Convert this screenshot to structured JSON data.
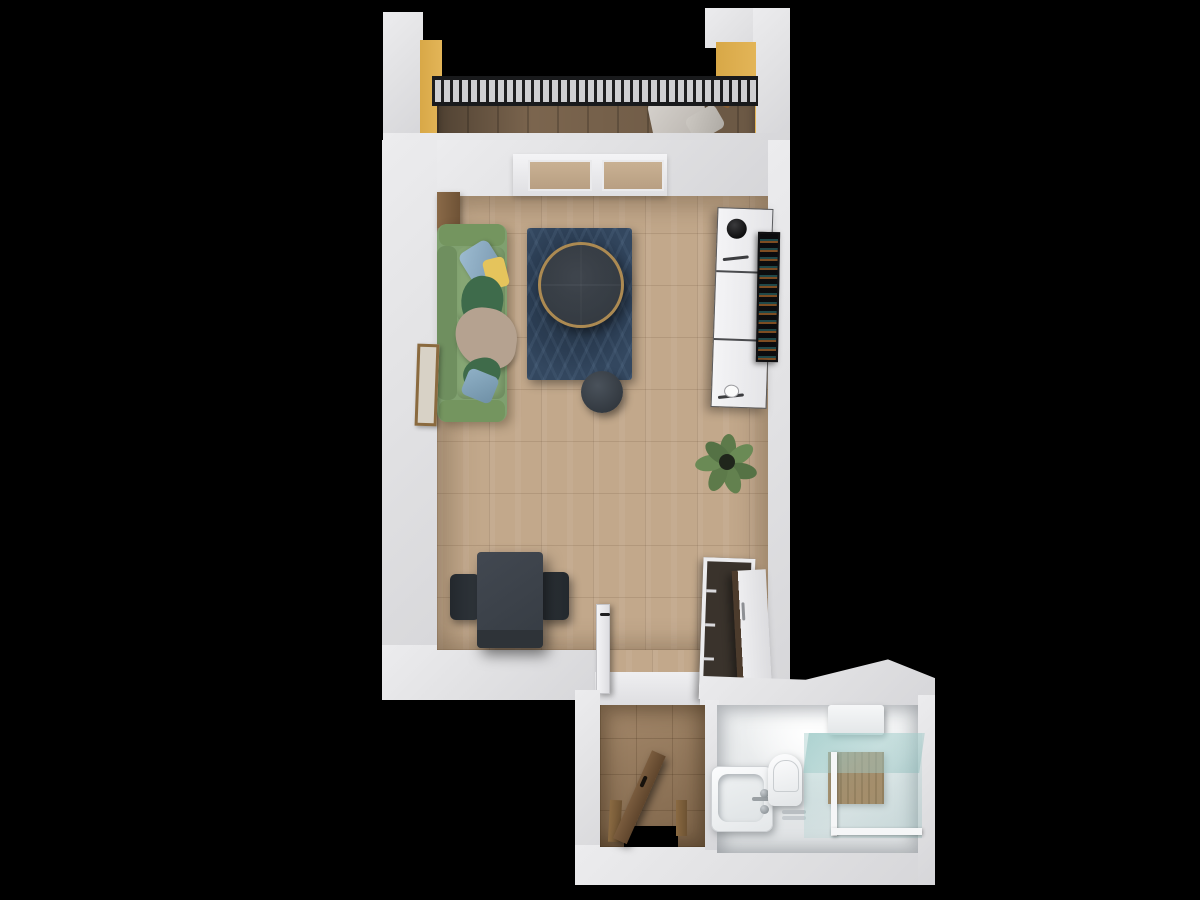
{
  "scene": {
    "title": "apartment-3d-floorplan-top-view",
    "background_color": "#000000",
    "wall_color": "#e4e4e6",
    "accent_wall_color": "#ddae4f"
  },
  "rooms": [
    {
      "id": "balcony",
      "label": "Balcony",
      "floor_color": "#7b654e",
      "accent_wall_color": "#ddae4f",
      "furniture": [
        {
          "name": "railing",
          "color": "#1d1d1f"
        },
        {
          "name": "lounge-chair",
          "color": "#cfcbc6",
          "frame_color": "#8a5f33"
        }
      ]
    },
    {
      "id": "living-room",
      "label": "Living Room",
      "floor_color": "#c2a88b",
      "furniture": [
        {
          "name": "balcony-window",
          "frame_color": "#f2f2f4"
        },
        {
          "name": "side-console",
          "color": "#8a6a48"
        },
        {
          "name": "sofa",
          "color": "#7fa06f",
          "pillows": [
            "#93b3c9",
            "#e5c45c",
            "#3e6b4b",
            "#8fb0c6"
          ],
          "blanket_color": "#b5a290"
        },
        {
          "name": "leaning-picture-frame",
          "color": "#8a6a3f"
        },
        {
          "name": "area-rug",
          "color": "#2b3d53"
        },
        {
          "name": "round-coffee-table",
          "top_color": "#40474f",
          "rim_color": "#ac8a52"
        },
        {
          "name": "pouf",
          "color": "#394048"
        },
        {
          "name": "potted-plant",
          "color": "#5d7a4a"
        },
        {
          "name": "shelving-unit",
          "color": "#f0f0f2",
          "decor": "black-round-pot"
        },
        {
          "name": "wall-art-tv",
          "color": "#17181a"
        },
        {
          "name": "dining-table",
          "color": "#3a4046"
        },
        {
          "name": "dining-chair-left",
          "color": "#2c3237"
        },
        {
          "name": "dining-chair-right",
          "color": "#2c3237"
        },
        {
          "name": "wardrobe",
          "front_color": "#e9e9eb",
          "side_color": "#4c3b2c",
          "interior_color": "#3a332c"
        },
        {
          "name": "interior-door-open",
          "color": "#f2f2f4",
          "handle_color": "#222222"
        }
      ]
    },
    {
      "id": "hallway",
      "label": "Hallway",
      "floor_color": "#9a7b5a",
      "furniture": [
        {
          "name": "entry-door-open",
          "color": "#6e5339",
          "frame_color": "#8a6a42"
        }
      ]
    },
    {
      "id": "bathroom",
      "label": "Bathroom",
      "floor_color": "#e8eaeb",
      "furniture": [
        {
          "name": "bathtub-with-faucet",
          "color": "#f4f5f6",
          "faucet_color": "#9aa0a4"
        },
        {
          "name": "toilet",
          "color": "#f4f5f6"
        },
        {
          "name": "shower-enclosure",
          "glass_color": "#8fc0bd",
          "floor_color": "#a2774a",
          "frame_color": "#f5f6f7"
        },
        {
          "name": "water-heater-cabinet",
          "color": "#f2f3f4"
        }
      ]
    }
  ]
}
